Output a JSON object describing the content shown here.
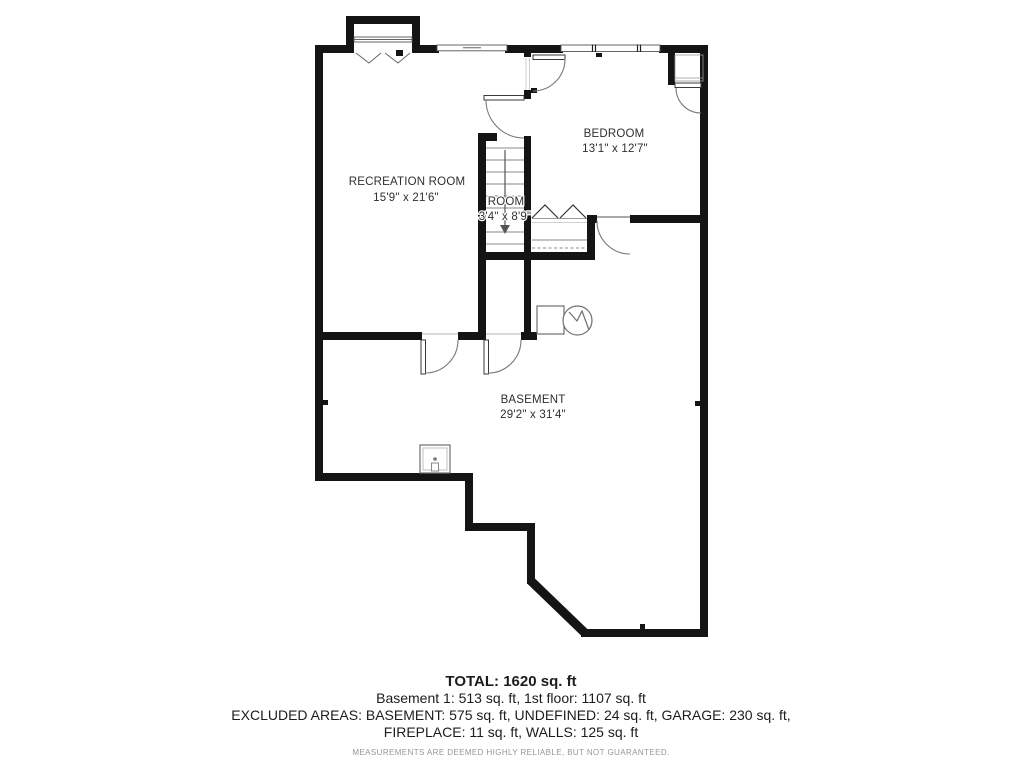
{
  "floorplan": {
    "rooms": [
      {
        "label": "RECREATION ROOM",
        "dims": "15'9\" x 21'6\""
      },
      {
        "label": "BEDROOM",
        "dims": "13'1\" x 12'7\""
      },
      {
        "label": "ROOM",
        "dims": "3'4\" x 8'9\""
      },
      {
        "label": "BASEMENT",
        "dims": "29'2\" x 31'4\""
      }
    ],
    "features": [
      "bay-window",
      "sliding-window",
      "bedroom-window",
      "stairs-down-arrow",
      "bifold-closet",
      "top-right-closet",
      "furnace",
      "water-heater",
      "laundry-tub"
    ],
    "colors": {
      "wall": "#141414",
      "line": "#666666",
      "text": "#2f2f2f"
    }
  },
  "summary": {
    "total": "TOTAL: 1620 sq. ft",
    "areas": "Basement 1: 513 sq. ft, 1st floor: 1107 sq. ft",
    "excluded_1": "EXCLUDED AREAS: BASEMENT: 575 sq. ft, UNDEFINED: 24 sq. ft, GARAGE: 230 sq. ft,",
    "excluded_2": "FIREPLACE: 11 sq. ft, WALLS: 125 sq. ft",
    "disclaimer": "MEASUREMENTS ARE DEEMED HIGHLY RELIABLE, BUT NOT GUARANTEED."
  }
}
